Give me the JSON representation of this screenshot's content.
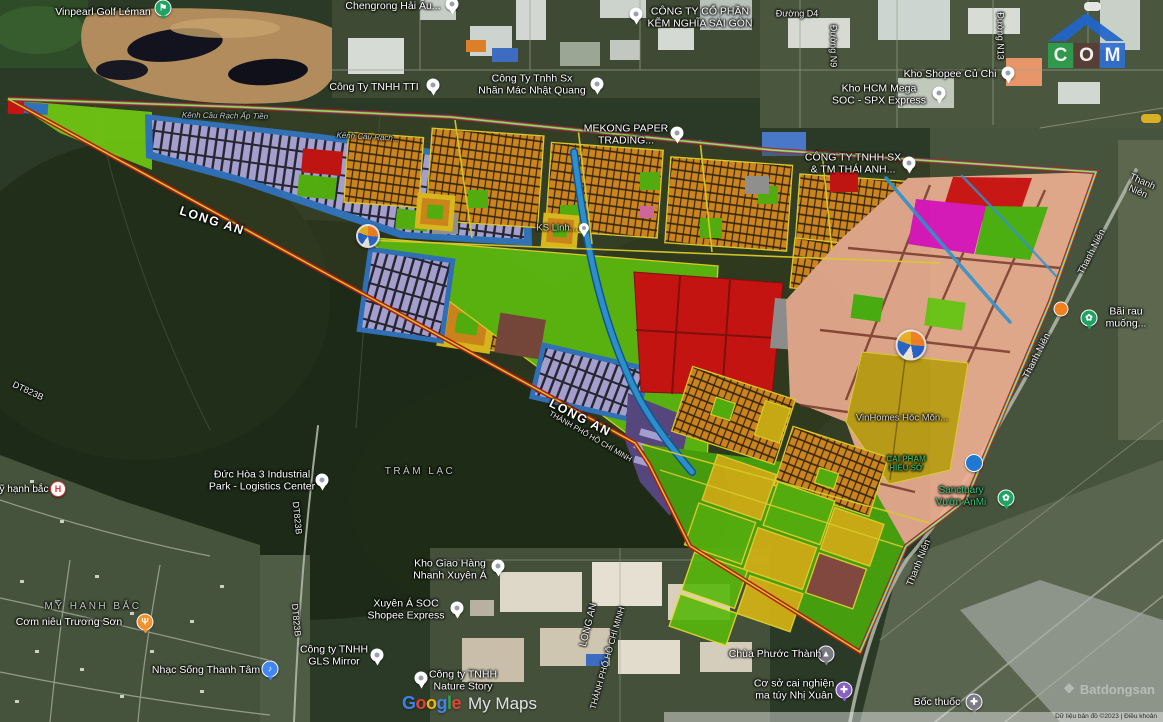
{
  "app": {
    "name": "Google My Maps satellite view with planning overlay"
  },
  "colors": {
    "boundary_red": "#d51212",
    "boundary_blue": "#2f7fd0",
    "boundary_chartreuse": "#c6e52e",
    "lot_orange": "#de8d1e",
    "lot_lavender": "#b2abe2",
    "frame_blue": "#3277c6",
    "zone_salmon": "#efb093",
    "zone_red": "#d51212",
    "zone_magenta": "#e515c5",
    "zone_lime": "#5fc00f",
    "zone_gold": "#d8b414",
    "zone_olive": "#c7a517",
    "zone_purple": "#5b4a8a",
    "zone_maroon": "#7e4a3e",
    "canal_blue": "#2e9ade",
    "school_yellow": "#e9c51d"
  },
  "logo": {
    "roof_color": "#2066cc",
    "letters": [
      {
        "ch": "C",
        "bg": "#2e9e4f"
      },
      {
        "ch": "O",
        "bg": "#5a3c34"
      },
      {
        "ch": "M",
        "bg": "#2f6fd0"
      }
    ]
  },
  "watermarks": {
    "google": {
      "letters": [
        {
          "ch": "G",
          "color": "#4285F4"
        },
        {
          "ch": "o",
          "color": "#EA4335"
        },
        {
          "ch": "o",
          "color": "#FBBC05"
        },
        {
          "ch": "g",
          "color": "#4285F4"
        },
        {
          "ch": "l",
          "color": "#34A853"
        },
        {
          "ch": "e",
          "color": "#EA4335"
        }
      ],
      "suffix": "My Maps"
    },
    "batdongsan": {
      "icon": "❖",
      "text": "Batdongsan"
    },
    "attribution": "Dữ liệu bản đồ ©2023   |   Điều khoản"
  },
  "map": {
    "labels": [
      {
        "id": "vinpearl-golf-leman",
        "text": "Vinpearl Golf Léman",
        "x": 103,
        "y": 12,
        "type": "poi",
        "click": true
      },
      {
        "id": "chengrong-hai-au",
        "text": "Chengrong Hải Âu...",
        "x": 393,
        "y": 6,
        "type": "poi",
        "click": true
      },
      {
        "id": "kem-nghia-sai-gon",
        "text": "CÔNG TY CỔ PHẦN\nKẼM NGHĨA SÀI GÒN",
        "x": 700,
        "y": 18,
        "type": "poi",
        "click": true
      },
      {
        "id": "duong-d4",
        "text": "Đường D4",
        "x": 797,
        "y": 14,
        "type": "road",
        "fs": 9
      },
      {
        "id": "duong-n9",
        "text": "Đường N9",
        "x": 833,
        "y": 46,
        "type": "road",
        "rot": 90,
        "fs": 9
      },
      {
        "id": "duong-n13",
        "text": "Đường N13",
        "x": 1000,
        "y": 36,
        "type": "road",
        "rot": 90,
        "fs": 9
      },
      {
        "id": "kho-shopee-cu-chi",
        "text": "Kho Shopee Củ Chi",
        "x": 950,
        "y": 74,
        "type": "poi",
        "click": true
      },
      {
        "id": "kho-hcm-mega",
        "text": "Kho HCM Mega\nSOC - SPX Express",
        "x": 879,
        "y": 95,
        "type": "poi",
        "click": true
      },
      {
        "id": "cong-ty-tti",
        "text": "Công Ty TNHH TTI",
        "x": 374,
        "y": 87,
        "type": "poi",
        "click": true
      },
      {
        "id": "nhan-mac-nhat-quang",
        "text": "Công Ty Tnhh Sx\nNhãn Mác Nhật Quang",
        "x": 532,
        "y": 85,
        "type": "poi",
        "click": true
      },
      {
        "id": "mekong-paper",
        "text": "MEKONG PAPER\nTRADING...",
        "x": 626,
        "y": 135,
        "type": "poi",
        "click": true
      },
      {
        "id": "thai-anh",
        "text": "CÔNG TY TNHH SX\n& TM THÁI ANH...",
        "x": 853,
        "y": 164,
        "type": "poi",
        "click": true
      },
      {
        "id": "kenh-cau-rach-ap-tien",
        "text": "Kênh Cầu Rạch Ấp Tiền",
        "x": 225,
        "y": 116,
        "type": "water",
        "rot": 1
      },
      {
        "id": "kenh-cau-rach-2",
        "text": "Kênh Cầu Rạch...",
        "x": 368,
        "y": 137,
        "type": "water",
        "rot": 3
      },
      {
        "id": "long-an-1",
        "text": "LONG AN",
        "x": 212,
        "y": 221,
        "type": "big",
        "rot": 18
      },
      {
        "id": "long-an-2",
        "text": "LONG AN",
        "x": 580,
        "y": 418,
        "type": "big",
        "rot": 27
      },
      {
        "id": "tp-hcm-1",
        "text": "THÀNH PHỐ HỒ CHÍ MINH",
        "x": 590,
        "y": 437,
        "type": "road",
        "rot": 30,
        "fs": 7.5
      },
      {
        "id": "long-an-3",
        "text": "LONG AN",
        "x": 589,
        "y": 625,
        "type": "road",
        "rot": -76,
        "fs": 10
      },
      {
        "id": "tp-hcm-2",
        "text": "THÀNH PHỐ HỒ CHÍ MINH",
        "x": 607,
        "y": 658,
        "type": "road",
        "rot": -74,
        "fs": 8.5
      },
      {
        "id": "dt823b-1",
        "text": "DT823B",
        "x": 28,
        "y": 391,
        "type": "road",
        "rot": 25,
        "fs": 9
      },
      {
        "id": "dt823b-2",
        "text": "DT823B",
        "x": 297,
        "y": 518,
        "type": "road",
        "rot": 84,
        "fs": 9
      },
      {
        "id": "dt823b-3",
        "text": "DT823B",
        "x": 296,
        "y": 620,
        "type": "road",
        "rot": 84,
        "fs": 9
      },
      {
        "id": "duc-hoa-3",
        "text": "Đức Hòa 3 Industrial\nPark - Logistics Center",
        "x": 262,
        "y": 481,
        "type": "poi",
        "click": true
      },
      {
        "id": "my-hanh-bac-poi",
        "text": "ỹ hạnh bắc",
        "x": 24,
        "y": 490,
        "type": "poi",
        "fs": 10,
        "click": true
      },
      {
        "id": "my-hanh-bac-area",
        "text": "MỸ HẠNH BẮC",
        "x": 93,
        "y": 607,
        "type": "area"
      },
      {
        "id": "com-nieu-truong-son",
        "text": "Cơm niêu Trương Sơn",
        "x": 69,
        "y": 622,
        "type": "poi",
        "click": true
      },
      {
        "id": "nhac-song-thanh-tam",
        "text": "Nhạc Sống Thanh Tâm",
        "x": 206,
        "y": 670,
        "type": "poi",
        "click": true
      },
      {
        "id": "gls-mirror",
        "text": "Công ty TNHH\nGLS Mirror",
        "x": 334,
        "y": 656,
        "type": "poi",
        "click": true
      },
      {
        "id": "tram-lac",
        "text": "TRÀM LẠC",
        "x": 420,
        "y": 472,
        "type": "area"
      },
      {
        "id": "kho-giao-hang-nhanh",
        "text": "Kho Giao Hàng\nNhanh Xuyên Á",
        "x": 450,
        "y": 570,
        "type": "poi",
        "click": true
      },
      {
        "id": "xuyen-a-soc",
        "text": "Xuyên Á SOC\nShopee Express",
        "x": 406,
        "y": 610,
        "type": "poi",
        "click": true
      },
      {
        "id": "nature-story",
        "text": "Công ty TNHH\nNature Story",
        "x": 463,
        "y": 681,
        "type": "poi",
        "click": true
      },
      {
        "id": "chua-phuoc-thanh",
        "text": "Chùa Phước Thành",
        "x": 775,
        "y": 654,
        "type": "poi",
        "click": true
      },
      {
        "id": "cai-nghien-nhi-xuan",
        "text": "Cơ sở cai nghiện\nma túy Nhị Xuân",
        "x": 794,
        "y": 690,
        "type": "poi",
        "click": true
      },
      {
        "id": "boc-thuoc",
        "text": "Bốc thuốc",
        "x": 937,
        "y": 702,
        "type": "poi",
        "click": true
      },
      {
        "id": "thanh-nien-1",
        "text": "Thanh Niên",
        "x": 1140,
        "y": 187,
        "type": "road",
        "rot": 24,
        "fs": 9.5
      },
      {
        "id": "thanh-nien-2",
        "text": "Thanh Niên",
        "x": 1092,
        "y": 252,
        "type": "road",
        "rot": -63,
        "fs": 9.5
      },
      {
        "id": "thanh-nien-3",
        "text": "Thanh Niên",
        "x": 1037,
        "y": 356,
        "type": "road",
        "rot": -63,
        "fs": 9.5
      },
      {
        "id": "thanh-nien-4",
        "text": "Thanh Niên",
        "x": 919,
        "y": 563,
        "type": "road",
        "rot": -68,
        "fs": 9.5
      },
      {
        "id": "bai-rau-muong",
        "text": "Bãi rau muống...",
        "x": 1126,
        "y": 318,
        "type": "poi",
        "click": true
      },
      {
        "id": "sanctuary-vuon-anmi",
        "text": "Sanctuary\nVườn AnMi",
        "x": 961,
        "y": 497,
        "type": "green",
        "click": true
      },
      {
        "id": "vinhomes-hoc-mon",
        "text": "VinHomes Hóc Môn...",
        "x": 902,
        "y": 418,
        "type": "faint"
      },
      {
        "id": "cai-pham-hieu-so",
        "text": "CAI PHAM\nHIẾU SỞ",
        "x": 906,
        "y": 464,
        "type": "greenfaint"
      },
      {
        "id": "ks-linh",
        "text": "KS Linh...",
        "x": 557,
        "y": 228,
        "type": "faint"
      }
    ],
    "markers": [
      {
        "id": "pin-chengrong",
        "kind": "pin",
        "x": 452,
        "y": 4
      },
      {
        "id": "pin-kem-nghia",
        "kind": "pin",
        "x": 636,
        "y": 14
      },
      {
        "id": "pin-shopee-cu-chi",
        "kind": "pin",
        "x": 1008,
        "y": 73
      },
      {
        "id": "pin-hcm-mega",
        "kind": "pin",
        "x": 939,
        "y": 93
      },
      {
        "id": "pin-tti",
        "kind": "pin",
        "x": 433,
        "y": 85
      },
      {
        "id": "pin-nhat-quang",
        "kind": "pin",
        "x": 597,
        "y": 84
      },
      {
        "id": "pin-mekong",
        "kind": "pin",
        "x": 677,
        "y": 133
      },
      {
        "id": "pin-thai-anh",
        "kind": "pin",
        "x": 909,
        "y": 163
      },
      {
        "id": "pin-ks-linh",
        "kind": "pin-sm",
        "x": 584,
        "y": 228
      },
      {
        "id": "pin-duc-hoa-3",
        "kind": "pin",
        "x": 322,
        "y": 480
      },
      {
        "id": "pin-gls-mirror",
        "kind": "pin",
        "x": 377,
        "y": 655
      },
      {
        "id": "pin-kho-giao-hang",
        "kind": "pin",
        "x": 498,
        "y": 566
      },
      {
        "id": "pin-xuyen-a",
        "kind": "pin",
        "x": 457,
        "y": 608
      },
      {
        "id": "pin-nature-story",
        "kind": "pin",
        "x": 421,
        "y": 678
      },
      {
        "id": "golf-icon",
        "kind": "circle",
        "x": 163,
        "y": 8,
        "color": "#1ea362",
        "glyph": "⚑"
      },
      {
        "id": "hospital-icon",
        "kind": "hospital",
        "x": 58,
        "y": 489,
        "glyph": "H"
      },
      {
        "id": "restaurant-icon",
        "kind": "circle",
        "x": 145,
        "y": 622,
        "color": "#f0912c",
        "glyph": "Ψ"
      },
      {
        "id": "music-icon",
        "kind": "circle",
        "x": 270,
        "y": 669,
        "color": "#4285f4",
        "glyph": "♪"
      },
      {
        "id": "temple-icon",
        "kind": "circle",
        "x": 826,
        "y": 654,
        "color": "#7b7b85",
        "glyph": "▲"
      },
      {
        "id": "rehab-icon",
        "kind": "circle",
        "x": 844,
        "y": 690,
        "color": "#8a5fc8",
        "glyph": "✚"
      },
      {
        "id": "medicine-icon",
        "kind": "circle",
        "x": 974,
        "y": 702,
        "color": "#7b7b85",
        "glyph": "✚"
      },
      {
        "id": "garden-icon-1",
        "kind": "circle",
        "x": 1089,
        "y": 318,
        "color": "#1ea362",
        "glyph": "✿"
      },
      {
        "id": "garden-icon-2",
        "kind": "circle",
        "x": 1006,
        "y": 498,
        "color": "#1ea362",
        "glyph": "✿"
      },
      {
        "id": "blue-poi-dot",
        "kind": "dot",
        "x": 974,
        "y": 463,
        "color": "#1f78d1",
        "size": 16
      },
      {
        "id": "orange-poi-dot",
        "kind": "dot",
        "x": 1061,
        "y": 309,
        "color": "#f08020",
        "size": 13
      },
      {
        "id": "compass-icon-small",
        "kind": "compass",
        "x": 368,
        "y": 236,
        "size": 20
      },
      {
        "id": "compass-icon-large",
        "kind": "compass",
        "x": 911,
        "y": 345,
        "size": 27
      }
    ]
  }
}
